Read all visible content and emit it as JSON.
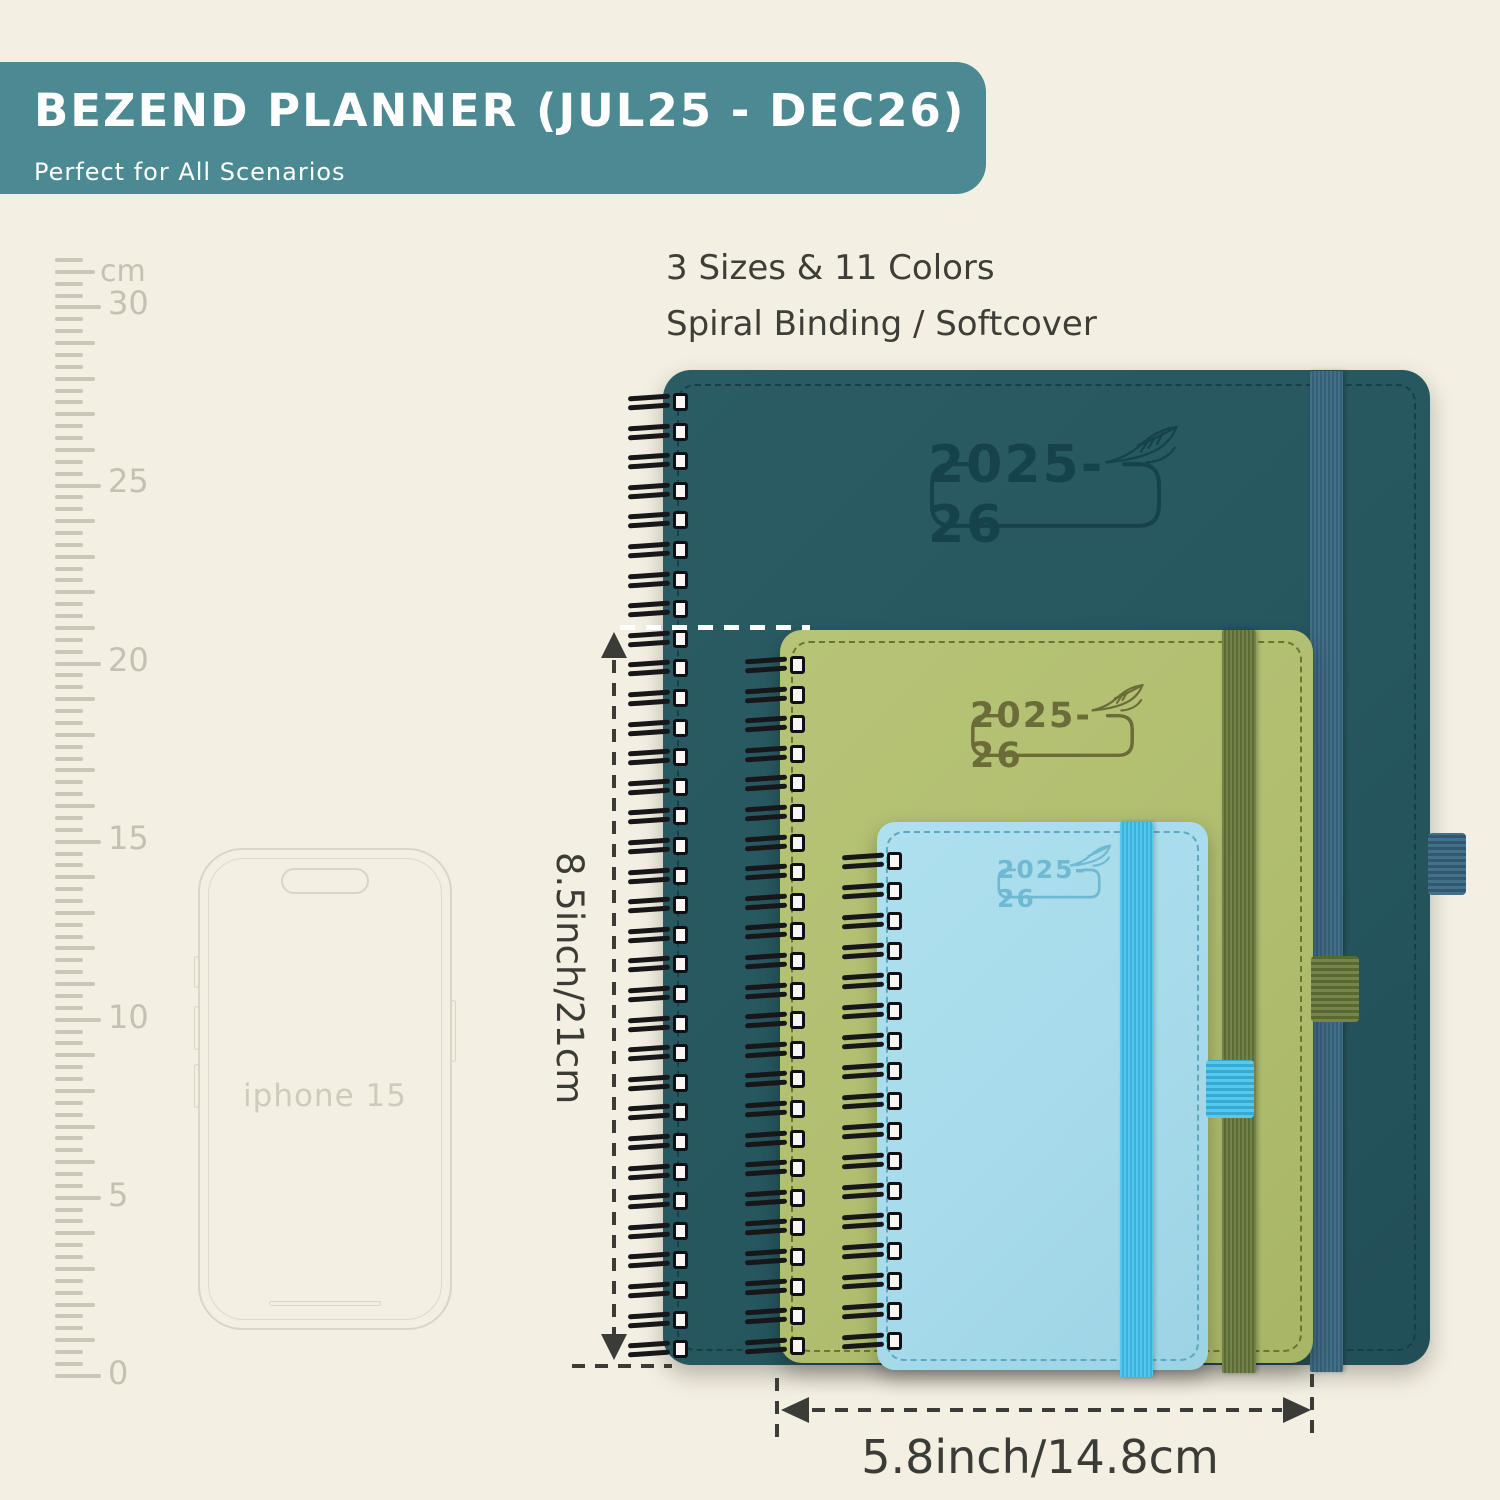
{
  "banner": {
    "title": "BEZEND PLANNER (JUL25 - DEC26)",
    "subtitle": "Perfect for All Scenarios"
  },
  "features": {
    "line1": "3 Sizes & 11 Colors",
    "line2": "Spiral Binding / Softcover"
  },
  "ruler": {
    "unit": "cm",
    "marks": [
      "30",
      "25",
      "20",
      "15",
      "10",
      "5",
      "0"
    ]
  },
  "phone": {
    "label": "iphone 15"
  },
  "planners": {
    "large": {
      "year": "2025-26",
      "cover_color": "#26565e"
    },
    "medium": {
      "year": "2025-26",
      "cover_color": "#b1be70"
    },
    "small": {
      "year": "2025-26",
      "cover_color": "#a7dbeb"
    }
  },
  "dimensions": {
    "height": "8.5inch/21cm",
    "width": "5.8inch/14.8cm"
  },
  "colors": {
    "background": "#f3efe2",
    "banner": "#4b8a92",
    "teal_band": "#3e6d84",
    "green_band": "#6d7c44",
    "blue_band": "#46c0e9",
    "annotation": "#3b3b37"
  }
}
